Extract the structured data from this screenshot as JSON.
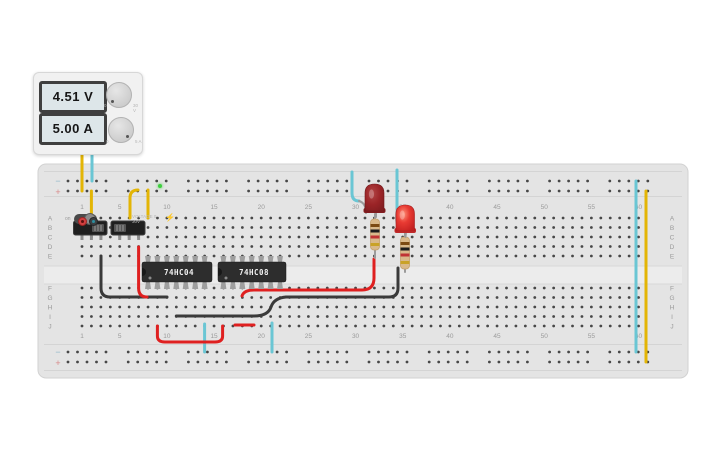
{
  "power_supply": {
    "voltage": "4.51 V",
    "current": "5.00 A",
    "on_label": "on",
    "zero_label": "0",
    "voltage_range_label": "30 V",
    "current_range_label": "5 A",
    "fine_print": "VOLTAGE 0-30V"
  },
  "breadboard": {
    "row_letters_top": [
      "A",
      "B",
      "C",
      "D",
      "E"
    ],
    "row_letters_bottom": [
      "F",
      "G",
      "H",
      "I",
      "J"
    ],
    "column_numbers": [
      1,
      5,
      10,
      15,
      20,
      25,
      30,
      35,
      40,
      45,
      50,
      55,
      60
    ],
    "rail_minus_label": "−",
    "rail_plus_label": "+",
    "columns": 60
  },
  "colors": {
    "yellow": "#e3b505",
    "cyan": "#6ac6d4",
    "red": "#df2020",
    "black": "#3a3a3a",
    "board": "#e4e4e4",
    "channel": "#ececec",
    "hole": "#474747",
    "label": "#9a9a9a",
    "ic_body": "#2d2d2d",
    "pin_gray": "#9e9e9e",
    "lead_gray": "#9b9b9b",
    "resistor_body": "#d9b98a",
    "led_off": "#9b2427",
    "led_on": "#d92c2c"
  },
  "components": {
    "ics": [
      {
        "name": "ic-74hc04",
        "label": "74HC04",
        "x": 142,
        "y": 262,
        "w": 70,
        "h": 20,
        "pin_cols": [
          148,
          157.4,
          166.9,
          176.3,
          185.7,
          195.2,
          204.6
        ]
      },
      {
        "name": "ic-74hc08",
        "label": "74HC08",
        "x": 218,
        "y": 262,
        "w": 68,
        "h": 20,
        "pin_cols": [
          223.4,
          232.9,
          242.3,
          251.7,
          261.2,
          270.6,
          280
        ]
      }
    ],
    "slide_switches": [
      {
        "name": "slide-switch-1",
        "x": 73.5,
        "y": 221,
        "w": 33.5,
        "h": 14,
        "knob": "right",
        "pin_xs": [
          82,
          91.4,
          100.9
        ]
      },
      {
        "name": "slide-switch-2",
        "x": 111,
        "y": 221,
        "w": 34,
        "h": 14,
        "knob": "left",
        "pin_xs": [
          119.7,
          129.2,
          138.6
        ]
      }
    ],
    "leds": [
      {
        "name": "led-1",
        "x": 365,
        "y": 184,
        "w": 19,
        "h": 29,
        "lit": false,
        "cathode": "M359,201 Q366,203 366,213",
        "anode": "M376,212 L376,217"
      },
      {
        "name": "led-2",
        "x": 396,
        "y": 205,
        "w": 18.5,
        "h": 28,
        "lit": true,
        "cathode": "M397,209 Q394.5,221 399,230",
        "anode": "M406,232 L405.5,237"
      }
    ],
    "resistors": [
      {
        "name": "resistor-1",
        "cx": 375,
        "top": 214,
        "bottom": 258,
        "body_y": 219,
        "body_h": 31
      },
      {
        "name": "resistor-2",
        "cx": 405,
        "top": 232,
        "bottom": 272,
        "body_y": 237,
        "body_h": 32
      }
    ]
  },
  "wires": [
    {
      "name": "wire-psu-positive",
      "color": "yellow",
      "path": "M82,152 L82,191"
    },
    {
      "name": "wire-psu-negative",
      "color": "cyan",
      "path": "M92,152 L92,181"
    },
    {
      "name": "wire-plus-to-switch1",
      "color": "yellow",
      "path": "M91.4,191 L91.4,218"
    },
    {
      "name": "wire-plus-to-switch2",
      "color": "yellow",
      "path": "M130,218 L130,198 Q130,190 138,190"
    },
    {
      "name": "wire-plus-to-ic1-vcc",
      "color": "yellow",
      "path": "M148,190 L148,218"
    },
    {
      "name": "wire-rail-minus-right",
      "color": "cyan",
      "path": "M636,181 L636,352"
    },
    {
      "name": "wire-rail-plus-right",
      "color": "yellow",
      "path": "M646,191 L646,362"
    },
    {
      "name": "wire-minus-to-led1",
      "color": "cyan",
      "path": "M352,172 L352,193 Q352,201 359,201"
    },
    {
      "name": "wire-minus-to-led2",
      "color": "cyan",
      "path": "M397,170 L397,209"
    },
    {
      "name": "wire-switch1-to-ic1",
      "color": "black",
      "path": "M101,256 L101,288 Q101,297 110,297 L167,297"
    },
    {
      "name": "wire-switch2-to-ic1",
      "color": "red",
      "path": "M138.6,247 L138.6,288 Q138.6,297 147,297"
    },
    {
      "name": "wire-ic2-to-resistor1",
      "color": "red",
      "path": "M242,296 Q244,290 254,290 L362,290 Q374,290 374,278 L374,259"
    },
    {
      "name": "wire-ic1-to-resistor2",
      "color": "black",
      "path": "M176.3,316 L254,316 Q268,316 271,307 Q274,298 286,297 L389,297 Q398,297 398,288 L398,268"
    },
    {
      "name": "wire-jumper-red-bottom",
      "color": "red",
      "path": "M235,325 L254,325"
    },
    {
      "name": "wire-ic1-gnd",
      "color": "cyan",
      "path": "M204.6,324 L204.6,352"
    },
    {
      "name": "wire-ic2-gnd",
      "color": "cyan",
      "path": "M272,323 L272,352"
    },
    {
      "name": "wire-ic1-out-to-ic2",
      "color": "red",
      "path": "M157.4,326 L157.4,336 Q157.4,342 165,342 L215,342 Q222.6,342 222.6,336 L222.6,326"
    }
  ]
}
